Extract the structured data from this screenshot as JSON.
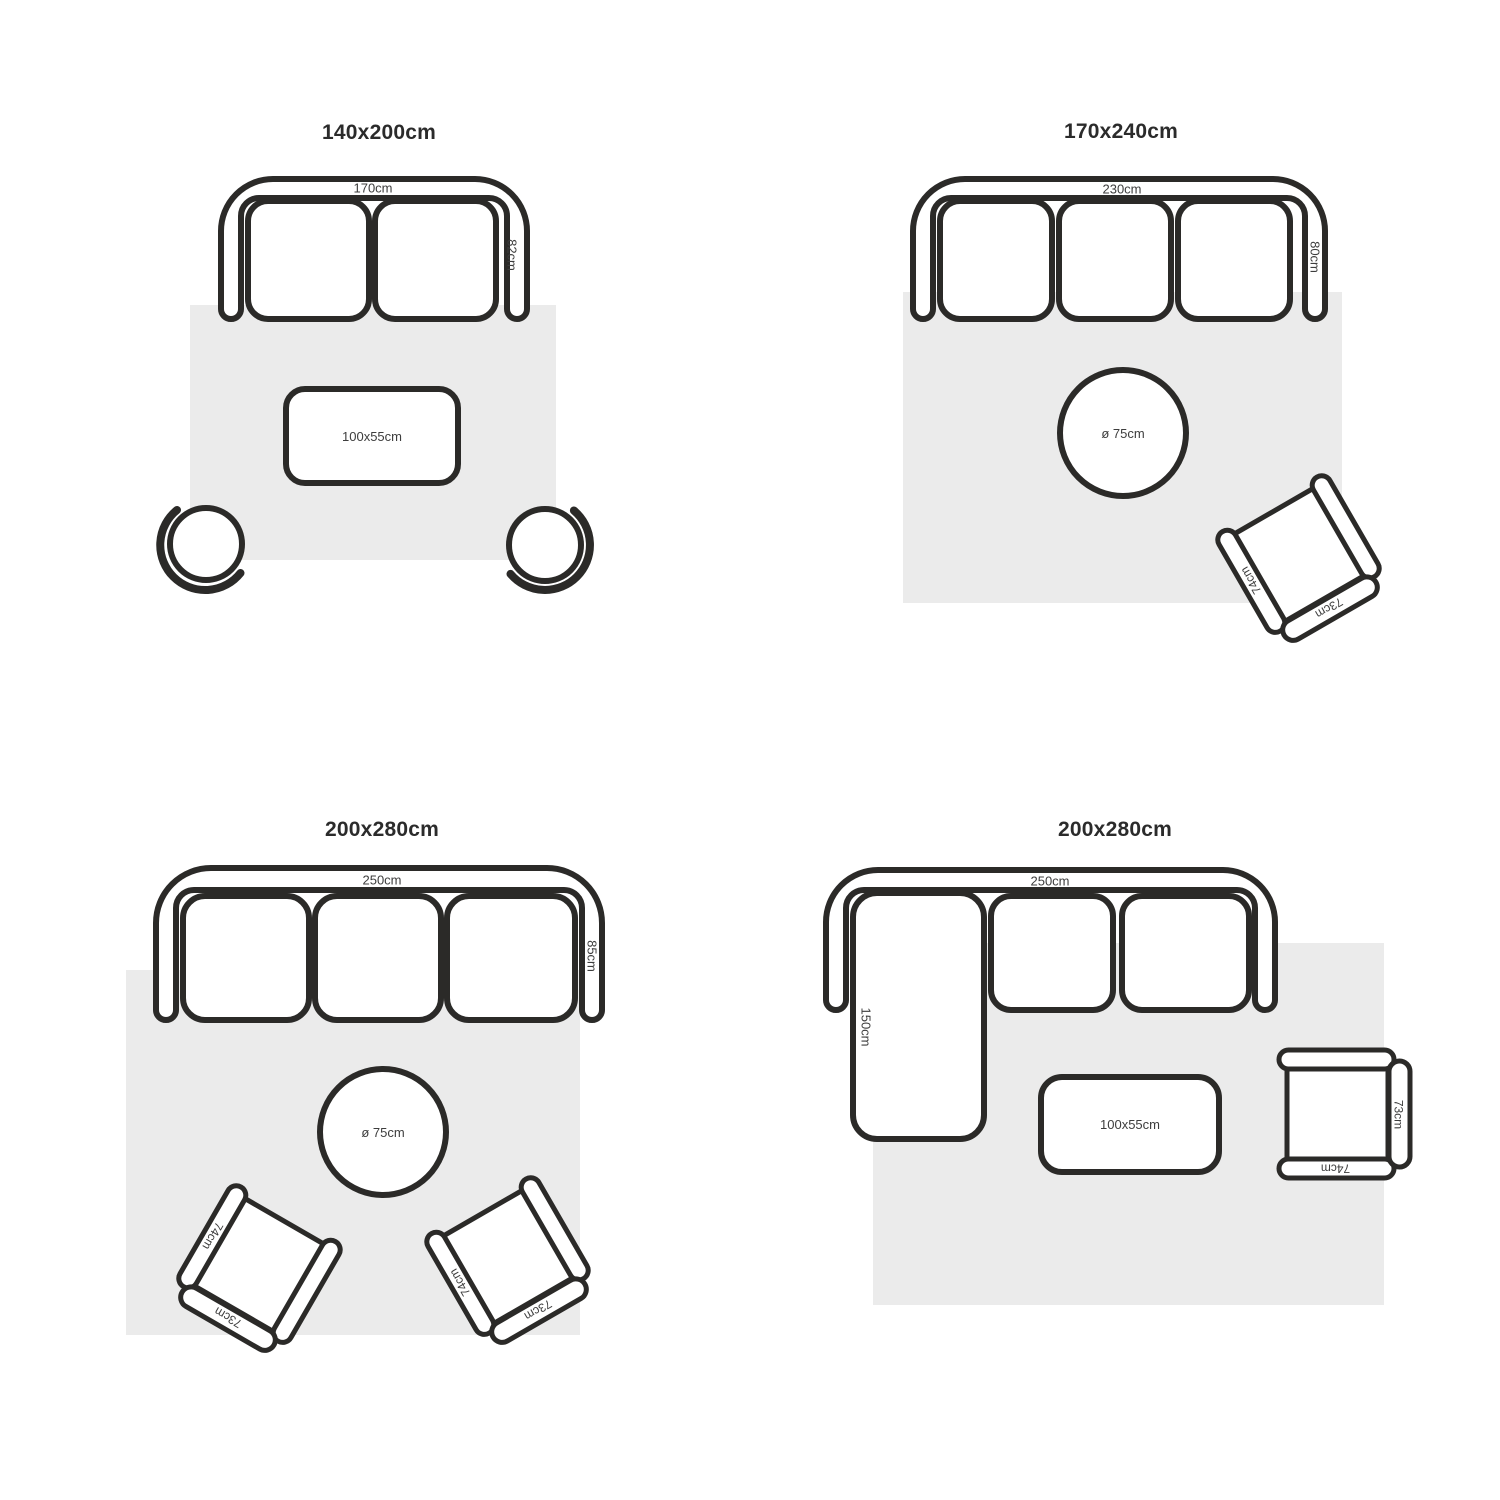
{
  "colors": {
    "outline": "#2b2a28",
    "rug": "#ebebeb",
    "label_text": "#3d3d3d",
    "title_text": "#2b2b2b"
  },
  "layouts": [
    {
      "title": "140x200cm",
      "sofa_type": "2-seat sofa",
      "sofa_width": "170cm",
      "sofa_depth": "82cm",
      "coffee_table": "100x55cm"
    },
    {
      "title": "170x240cm",
      "sofa_type": "3-seat sofa",
      "sofa_width": "230cm",
      "sofa_depth": "80cm",
      "round_table": "ø 75cm",
      "armchair_width": "74cm",
      "armchair_depth": "73cm"
    },
    {
      "title": "200x280cm",
      "sofa_type": "3-seat sofa",
      "sofa_width": "250cm",
      "sofa_depth": "85cm",
      "round_table": "ø 75cm",
      "armchair_left_width": "74cm",
      "armchair_left_depth": "73cm",
      "armchair_right_width": "74cm",
      "armchair_right_depth": "73cm"
    },
    {
      "title": "200x280cm",
      "sofa_type": "corner sofa with chaise",
      "sofa_width": "250cm",
      "chaise_depth": "150cm",
      "coffee_table": "100x55cm",
      "armchair_width": "74cm",
      "armchair_depth": "73cm"
    }
  ]
}
